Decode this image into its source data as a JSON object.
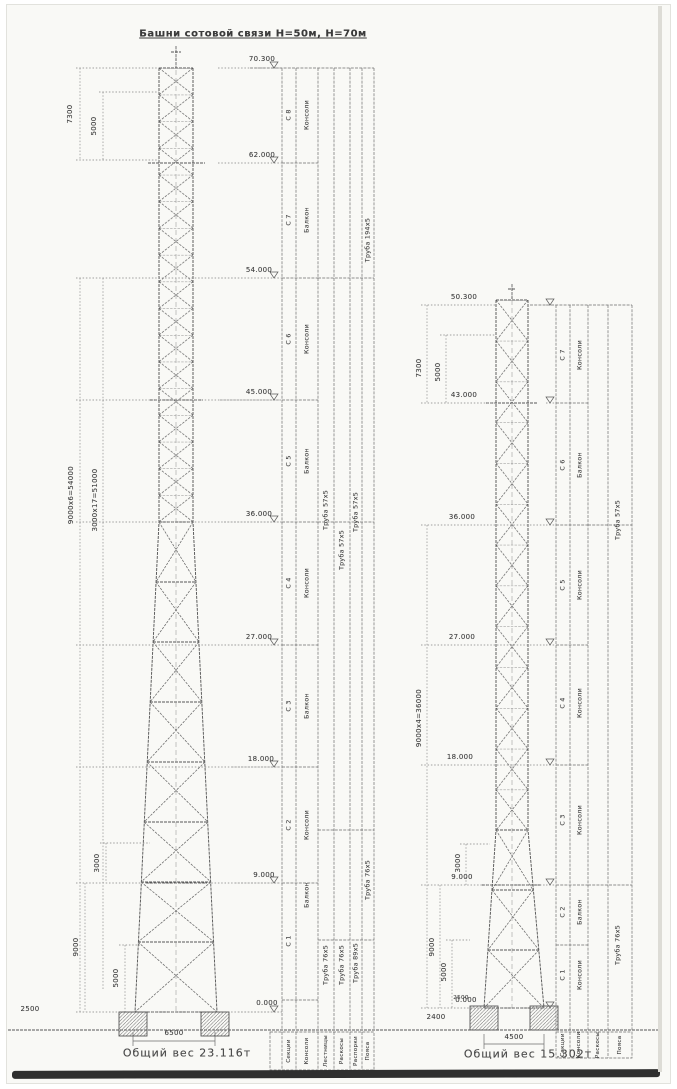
{
  "sheet": {
    "title": "Башни сотовой связи Н=50м, Н=70м",
    "colors": {
      "ink": "#5e5e5e",
      "paper": "#f9f9f6",
      "scan_edge": "#2f2f2f"
    }
  },
  "left_tower": {
    "caption": "Общий вес 23.116т",
    "elevations": [
      "70.300",
      "62.000",
      "54.000",
      "45.000",
      "36.000",
      "27.000",
      "18.000",
      "9.000",
      "0.000"
    ],
    "dims": {
      "top_outer": "7300",
      "top_inner": "5000",
      "main_outer": "9000х6=54000",
      "main_inner": "3000х17=51000",
      "low_3000": "3000",
      "low_9000": "9000",
      "low_5000": "5000",
      "ground_offset": "2500",
      "base_width": "6500"
    },
    "sections": [
      "С 8",
      "С 7",
      "С 6",
      "С 5",
      "С 4",
      "С 3",
      "С 2",
      "С 1"
    ],
    "attachments": [
      "Консоли",
      "Балкон",
      "Консоли",
      "Балкон",
      "Консоли",
      "Балкон",
      "Консоли",
      "Балкон"
    ],
    "pipes": {
      "top": "Труба 194х5",
      "mid_a": "Труба 57х5",
      "mid_b": "Труба 57х5",
      "mid_c": "Труба 57х5",
      "low_a": "Труба 76х5",
      "low_b": "Труба 76х5",
      "low_c": "Труба 89х5",
      "low_d": "Труба 76х5"
    },
    "table_headers": [
      "Секции",
      "Консоли",
      "Лестницы",
      "Раскосы",
      "Распорки",
      "Пояса"
    ]
  },
  "right_tower": {
    "caption": "Общий вес 15.302т",
    "elevations": [
      "50.300",
      "43.000",
      "36.000",
      "27.000",
      "18.000",
      "9.000",
      "0.000"
    ],
    "dims": {
      "top_outer": "7300",
      "top_inner": "5000",
      "main": "9000х4=36000",
      "low_3000": "3000",
      "low_9000": "9000",
      "low_5000": "5000",
      "low_2500": "2500",
      "ground_offset": "2400",
      "base_width": "4500"
    },
    "sections": [
      "С 7",
      "С 6",
      "С 5",
      "С 4",
      "С 3",
      "С 2",
      "С 1"
    ],
    "attachments": [
      "Консоли",
      "Балкон",
      "Консоли",
      "Консоли",
      "Консоли",
      "Балкон",
      "Консоли"
    ],
    "pipes": {
      "mid": "Труба 57х5",
      "low": "Труба 76х5"
    },
    "table_headers": [
      "Секции",
      "Консоли",
      "Раскосы",
      "Пояса"
    ]
  }
}
